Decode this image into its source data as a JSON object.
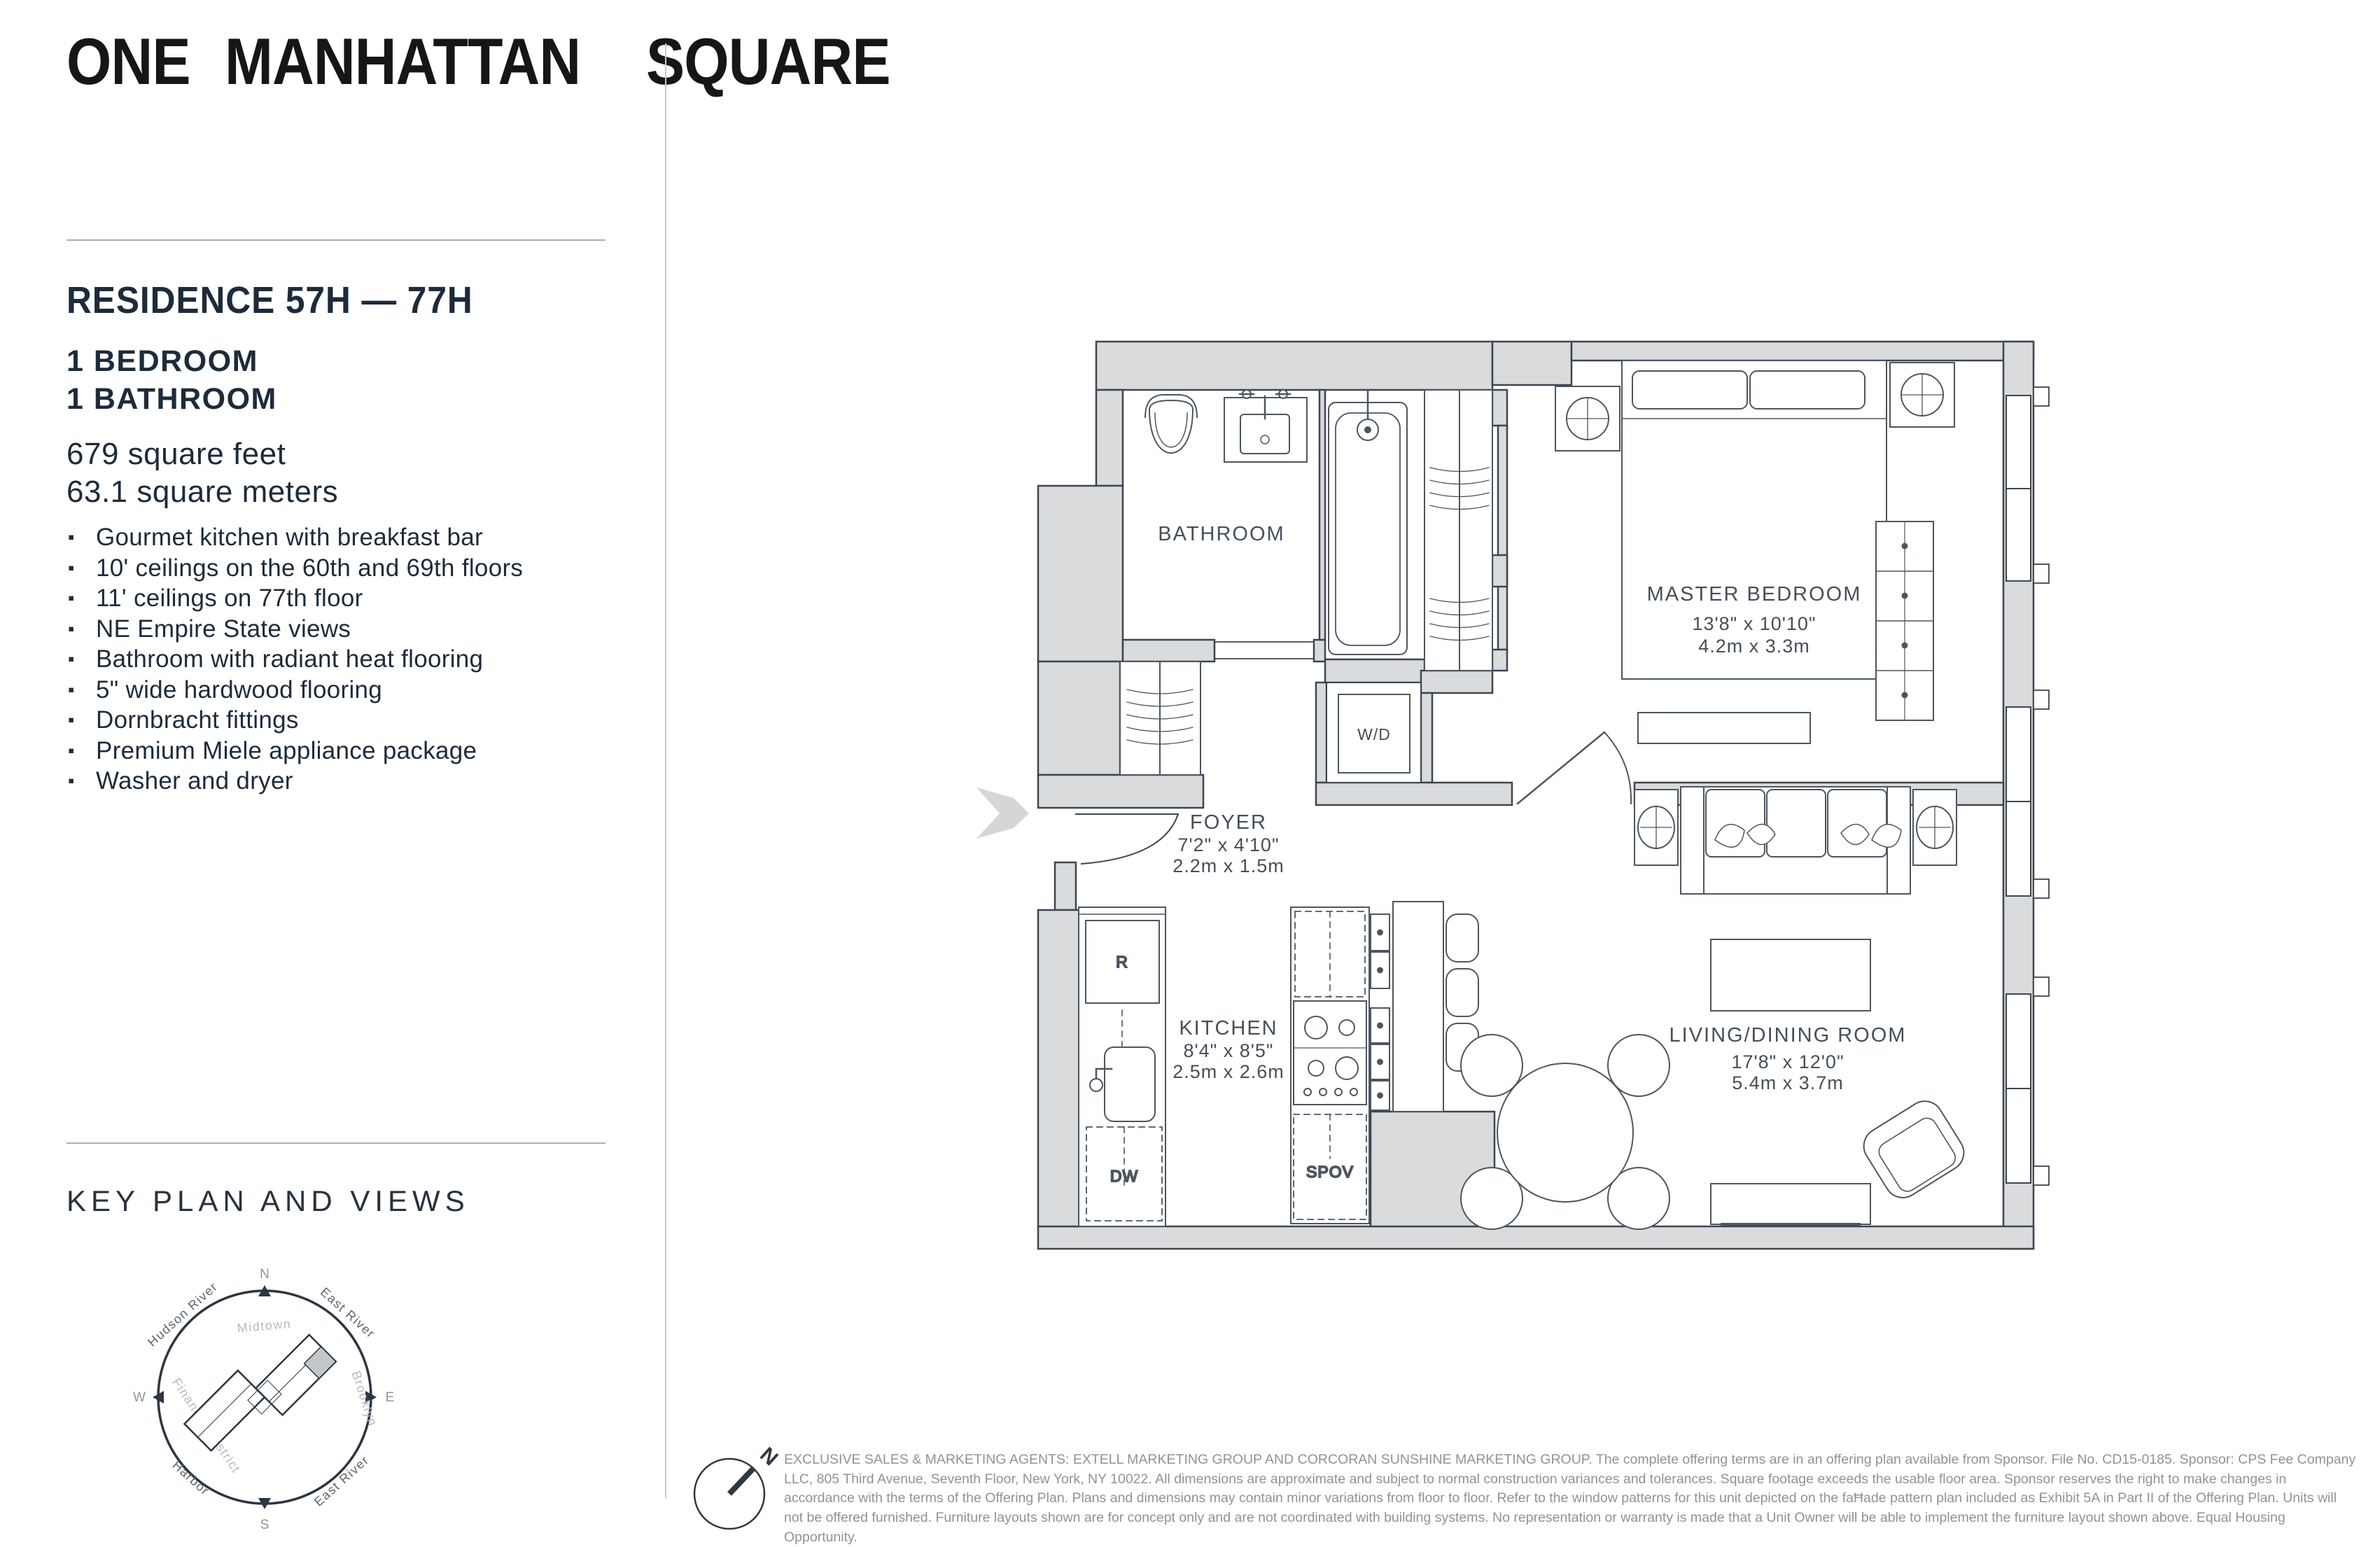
{
  "brand": {
    "line1": "ONE",
    "line2": "MANHATTAN",
    "line3": "SQUARE"
  },
  "residence": {
    "title": "RESIDENCE 57H — 77H",
    "bedrooms": "1 BEDROOM",
    "bathrooms": "1 BATHROOM",
    "area_sqft": "679 square feet",
    "area_sqm": "63.1 square meters"
  },
  "features": [
    "Gourmet kitchen with breakfast bar",
    "10' ceilings on the 60th and 69th floors",
    "11' ceilings on 77th floor",
    "NE Empire State views",
    "Bathroom with radiant heat flooring",
    "5\" wide hardwood flooring",
    "Dornbracht fittings",
    "Premium Miele appliance package",
    "Washer and dryer"
  ],
  "key_plan": {
    "title": "KEY PLAN AND VIEWS",
    "compass": {
      "n": "N",
      "e": "E",
      "s": "S",
      "w": "W"
    },
    "labels": {
      "hudson_river": "Hudson River",
      "east_river_ne": "East River",
      "brooklyn": "Brooklyn",
      "east_river_se": "East River",
      "harbor": "Harbor",
      "midtown": "Midtown",
      "financial_district": "Financial District"
    }
  },
  "floor_plan": {
    "north_indicator": "N",
    "rooms": {
      "bathroom": {
        "name": "BATHROOM"
      },
      "foyer": {
        "name": "FOYER",
        "dim_ft": "7'2\" x 4'10\"",
        "dim_m": "2.2m x 1.5m"
      },
      "kitchen": {
        "name": "KITCHEN",
        "dim_ft": "8'4\" x 8'5\"",
        "dim_m": "2.5m x 2.6m"
      },
      "master_bedroom": {
        "name": "MASTER BEDROOM",
        "dim_ft": "13'8\" x 10'10\"",
        "dim_m": "4.2m x 3.3m"
      },
      "living_dining": {
        "name": "LIVING/DINING ROOM",
        "dim_ft": "17'8\" x 12'0\"",
        "dim_m": "5.4m x 3.7m"
      }
    },
    "appliances": {
      "washer_dryer": "W/D",
      "refrigerator": "R",
      "dishwasher": "DW",
      "speed_oven": "SPOV"
    }
  },
  "legal": {
    "disclaimer": "EXCLUSIVE SALES & MARKETING AGENTS: EXTELL MARKETING GROUP AND CORCORAN SUNSHINE MARKETING GROUP. The complete offering terms are in an offering plan available from Sponsor. File No. CD15-0185. Sponsor: CPS Fee Company LLC, 805 Third Avenue, Seventh Floor, New York, NY 10022.  All dimensions are approximate and subject to normal construction variances and tolerances. Square footage exceeds the usable floor area. Sponsor reserves the right to make changes in accordance with the terms of the Offering Plan. Plans and dimensions may contain minor variations from floor to floor. Refer to the window patterns for this unit depicted on the faĦade pattern plan included as Exhibit 5A in Part II of the Offering Plan. Units will not be offered furnished. Furniture layouts shown are for concept only and are not coordinated with building systems.  No representation or warranty is made that a Unit Owner will be able to implement the furniture layout shown above. Equal Housing Opportunity."
  },
  "colors": {
    "navy": "#1d2b3a",
    "wall_gray": "#dadbdd",
    "plan_line": "#3d4650",
    "furniture_line": "#4d5660",
    "light_gray": "#9aa0a6",
    "disclaimer_gray": "#8f9397"
  }
}
